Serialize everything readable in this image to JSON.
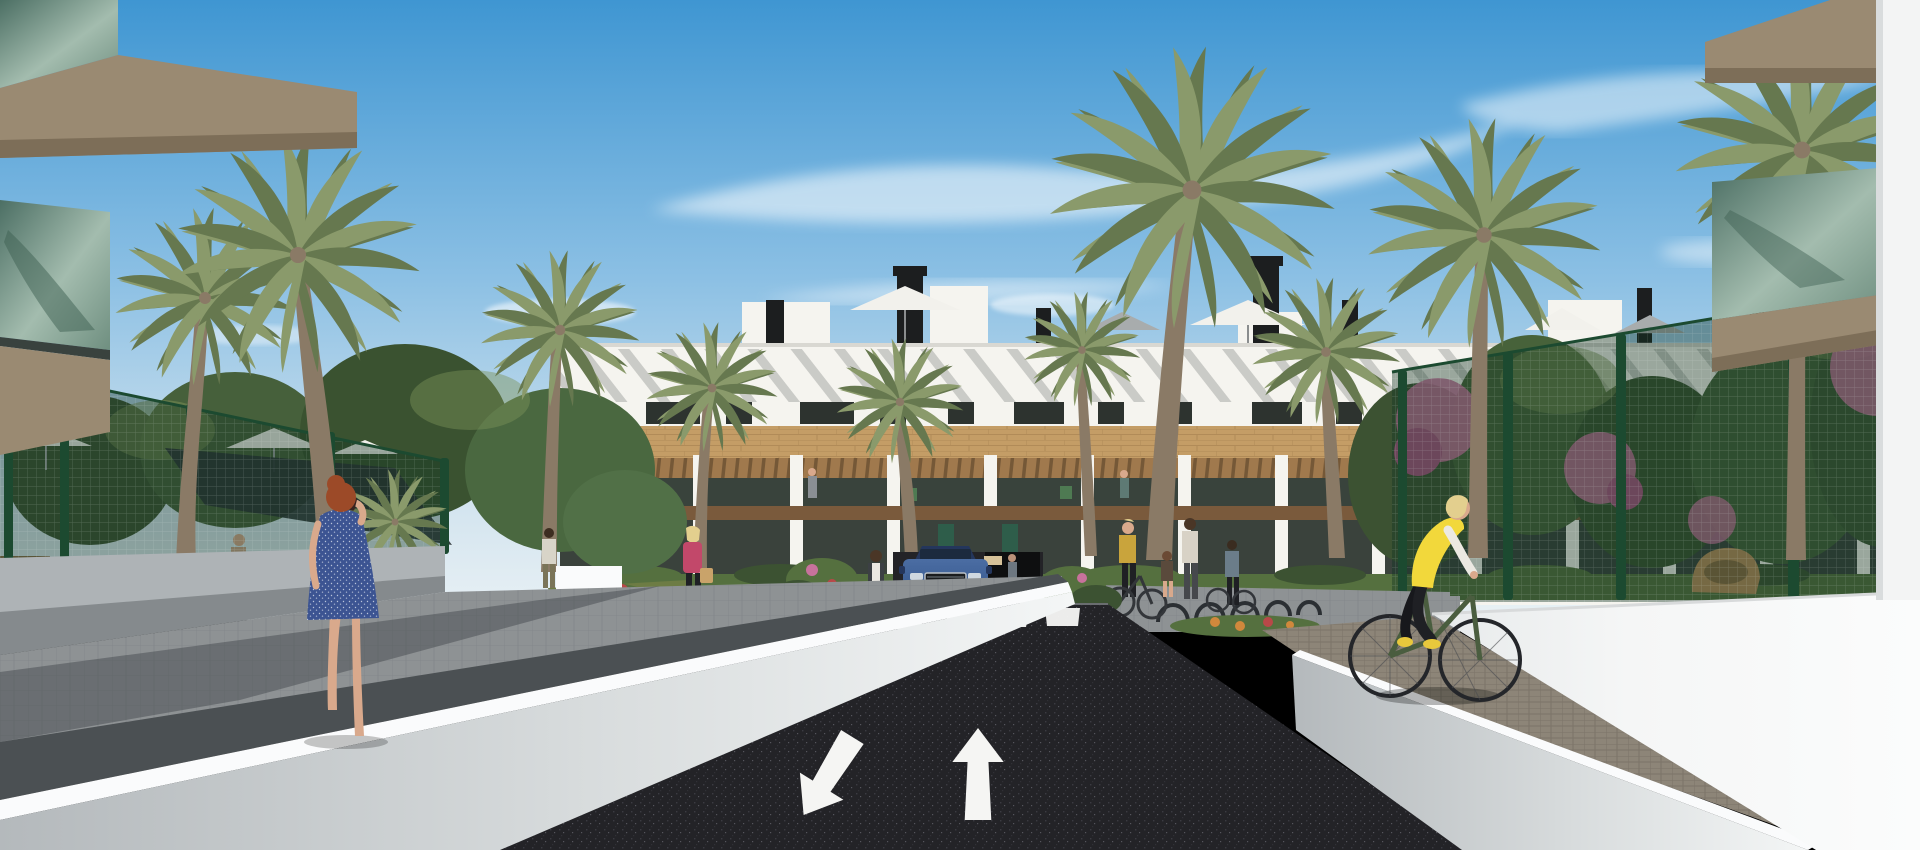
{
  "scene": {
    "type": "3d-architectural-render",
    "title": "New-build residential complex street view",
    "description": "Photorealistic render of a modern two-storey white apartment complex with wooden facade band and pergola terraces, lined with tall palm trees under a blue sky. A dark asphalt access road with painted white direction arrows and a zebra crosswalk leads to an underground garage ramp where a blue SUV exits. A woman in a blue dress walks on the left pathway talking on her phone, pedestrians gather near bike racks, and a woman in a yellow vest cycles along the right-hand paved path between white ramp walls and green mesh garden fences with bougainvillea.",
    "time_of_day": "sunny day",
    "road_markings": {
      "big_arrows": [
        "down-left",
        "up"
      ],
      "small_arrows_at_ramp": [
        "down",
        "up"
      ],
      "crosswalk_stripes": 6
    },
    "vehicles": [
      {
        "type": "suv",
        "color_name": "blue",
        "location": "garage ramp, front view"
      },
      {
        "type": "bicycle",
        "color_name": "olive green",
        "location": "right paved path"
      }
    ],
    "people": [
      "woman in blue polka-dot dress with auburn hair on phone, left path",
      "blonde woman in yellow vest riding bicycle, right path",
      "man in sleeveless top walking in left garden",
      "woman in pink jacket with tan handbag near building",
      "pedestrians and children near bike racks by entrance",
      "person standing at top of garage ramp",
      "small figures on first-floor terraces"
    ],
    "vegetation": {
      "palm_trees": 11,
      "left_garden": [
        "leafy trees",
        "white parasols",
        "dark shade sail",
        "wooden bench"
      ],
      "right_garden": [
        "bougainvillea pink clusters",
        "shrubs",
        "rattan lounge chair"
      ]
    },
    "building": {
      "storeys": 2,
      "features": [
        "white parapet roof",
        "black chimneys",
        "roof parasols",
        "diagonal pergola shadows",
        "wood-clad band",
        "pergola terraces",
        "green entrance doors",
        "front hedge"
      ]
    }
  },
  "colors": {
    "sky_top": "#3f96d2",
    "sky_mid": "#8cc0e4",
    "sky_horizon": "#e9f1f5",
    "cloud_white": "#ffffff",
    "building_white": "#f5f4ef",
    "parapet_shadow": "#d9d8d2",
    "window_dark": "#2d332f",
    "wood_band": "#c49d66",
    "pergola_wood": "#a97e4f",
    "balcony_wood": "#7a5a3c",
    "terrace_dark": "#39433c",
    "groundfloor_dark": "#3a423c",
    "door_green": "#2e5d4a",
    "foliage_dark": "#3c5232",
    "foliage_mid": "#55703f",
    "foliage_light": "#7d9258",
    "palm_frond": "#66784f",
    "palm_frond_light": "#8a9a6b",
    "trunk_brown": "#8a7a66",
    "fence_green": "#1c4a30",
    "mesh_tint": "rgba(18,52,36,0.40)",
    "flower_pink": "#c8729c",
    "flower_red": "#b84848",
    "flower_orange": "#d0883c",
    "lawn_green": "#6d7c44",
    "sidewalk_gray": "#8e9294",
    "paver_brown": "#8d8578",
    "asphalt_dark": "#232327",
    "marking_white": "#f5f5f3",
    "wall_light": "#aeb3b6",
    "wall_shadow": "#4b5053",
    "coping_white": "#fafbfc",
    "big_wall_white": "#f3f4f4",
    "slab_tan": "#9a8a72",
    "slab_tan_dark": "#7d6e58",
    "glass_teal": "#4c6f64",
    "glass_teal_light": "#a3bcae",
    "chimney_black": "#1c1e1f",
    "umbrella_white": "#f2f1ec",
    "umbrella_gray": "#a8acad",
    "shade_sail": "#2c3336",
    "car_blue": "#3d5f95",
    "car_blue_dark": "#24365c",
    "car_glass": "#1c2a3e",
    "vest_yellow": "#f2d83b",
    "dress_blue": "#3c5492",
    "skin_tone": "#d9a98c",
    "hair_red": "#9c4a28",
    "hair_blonde": "#e3cf8e",
    "bike_green": "#4a5d3f",
    "jacket_pink": "#c2486a",
    "shirt_white": "#ece9e2",
    "pants_dark": "#1f2024",
    "bag_tan": "#c9a36a",
    "wood_bench": "#8a6b45",
    "rattan_tan": "#b98d5a"
  }
}
